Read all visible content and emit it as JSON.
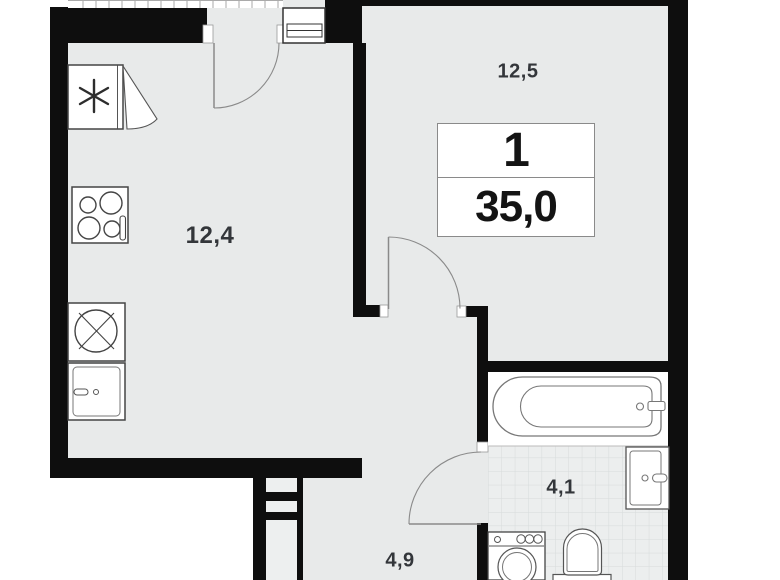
{
  "apartment": {
    "number": "1",
    "area_m2": "35,0"
  },
  "rooms": [
    {
      "name": "kitchen-living-room",
      "area_label": "12,4"
    },
    {
      "name": "room",
      "area_label": "12,5"
    },
    {
      "name": "bathroom",
      "area_label": "4,1"
    },
    {
      "name": "hallway",
      "area_label": "4,9"
    }
  ],
  "colors": {
    "wall": "#0e0e0e",
    "floor": "#e8eaea",
    "tile_background": "#eceeee",
    "tile_line": "#d6dbdb",
    "outside": "#ffffff",
    "fixture_stroke": "#555555",
    "door_arc": "#8a8a8a",
    "label_text": "#33363a",
    "info_box_border": "#8a8a8a"
  },
  "icons": {
    "fridge": "fridge-snowflake-icon",
    "stove": "stove-4-burner-icon",
    "kitchen_sink": "sink-cross-icon",
    "bathtub": "bathtub-icon",
    "washbasin": "washbasin-icon",
    "washer": "washing-machine-icon",
    "toilet": "toilet-icon"
  }
}
